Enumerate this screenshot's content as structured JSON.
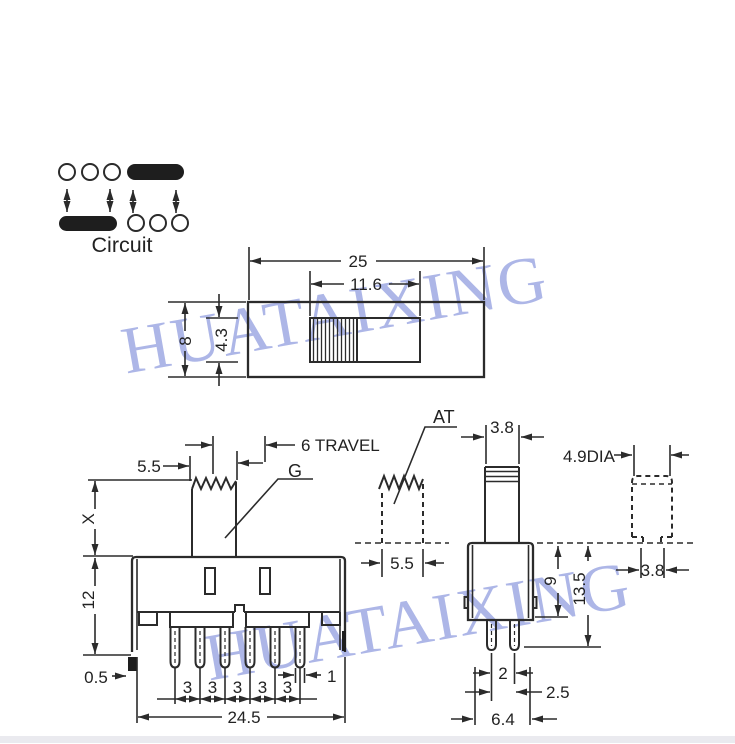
{
  "watermark": {
    "text": "HUATAIXING",
    "color": "#a9b3e6"
  },
  "circuit": {
    "label": "Circuit"
  },
  "top_view": {
    "width": "25",
    "slot_width": "11.6",
    "height": "8",
    "slot_height": "4.3"
  },
  "front_view": {
    "knob_width": "5.5",
    "travel": "6 TRAVEL",
    "knob_ref": "G",
    "knob_height": "X",
    "body_height": "12",
    "tab_thickness": "0.5",
    "pin_pitch": [
      "3",
      "3",
      "3",
      "3",
      "3"
    ],
    "pin_width": "1",
    "body_width": "24.5"
  },
  "actuator_detail": {
    "label": "AT",
    "width": "5.5"
  },
  "side_view": {
    "knob_width": "3.8",
    "body_height": "9",
    "total_height": "13.5",
    "pin_gap": "2",
    "pin_offset": "2.5",
    "depth": "6.4"
  },
  "cap_detail": {
    "label": "4.9DIA",
    "base_width": "3.8"
  }
}
